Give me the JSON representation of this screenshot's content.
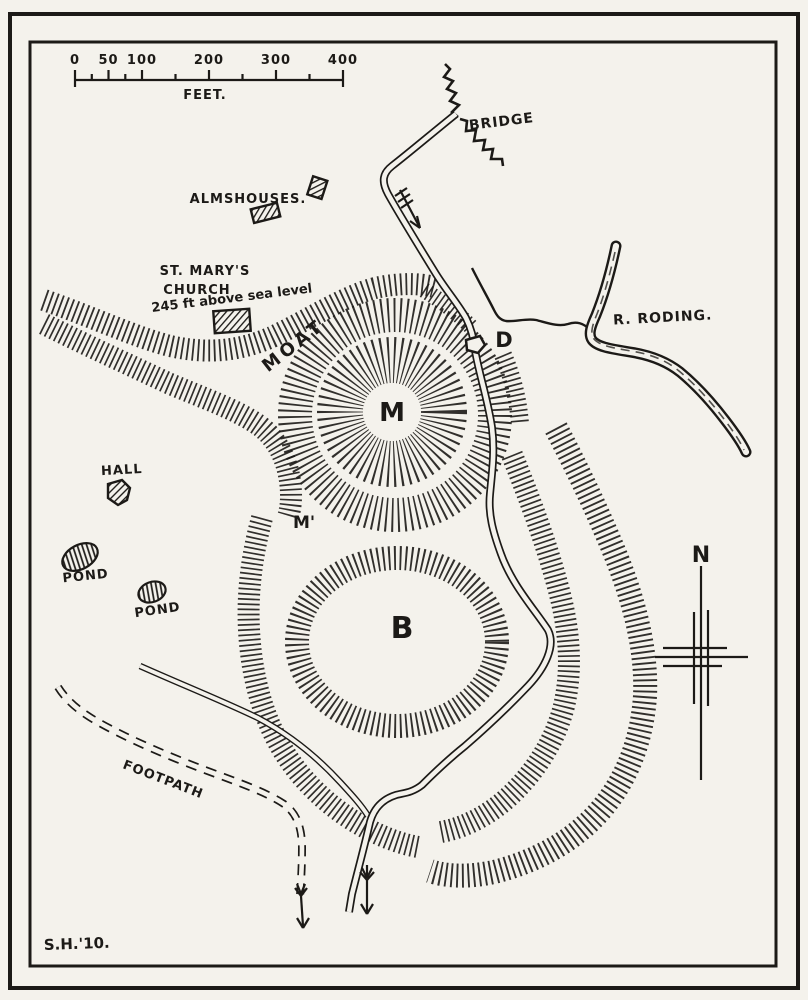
{
  "map": {
    "paper_color": "#f4f2ec",
    "ink_color": "#1c1a17",
    "scale_bar": {
      "unit": "FEET.",
      "tick_labels": [
        "0",
        "50",
        "100",
        "200",
        "300",
        "400"
      ]
    },
    "compass": {
      "north": "N"
    },
    "features": {
      "bridge": "BRIDGE",
      "almshouses": "ALMSHOUSES.",
      "church_line1": "ST. MARY'S",
      "church_line2": "CHURCH",
      "church_line3": "245 ft above sea level",
      "moat": "MOAT",
      "river": "R. RODING.",
      "hall": "HALL",
      "pond_west": "POND",
      "pond_south": "POND",
      "footpath": "FOOTPATH",
      "motte": "M",
      "motte_prime": "M'",
      "bailey": "B",
      "dam": "D"
    },
    "signature": "S.H.'10."
  }
}
